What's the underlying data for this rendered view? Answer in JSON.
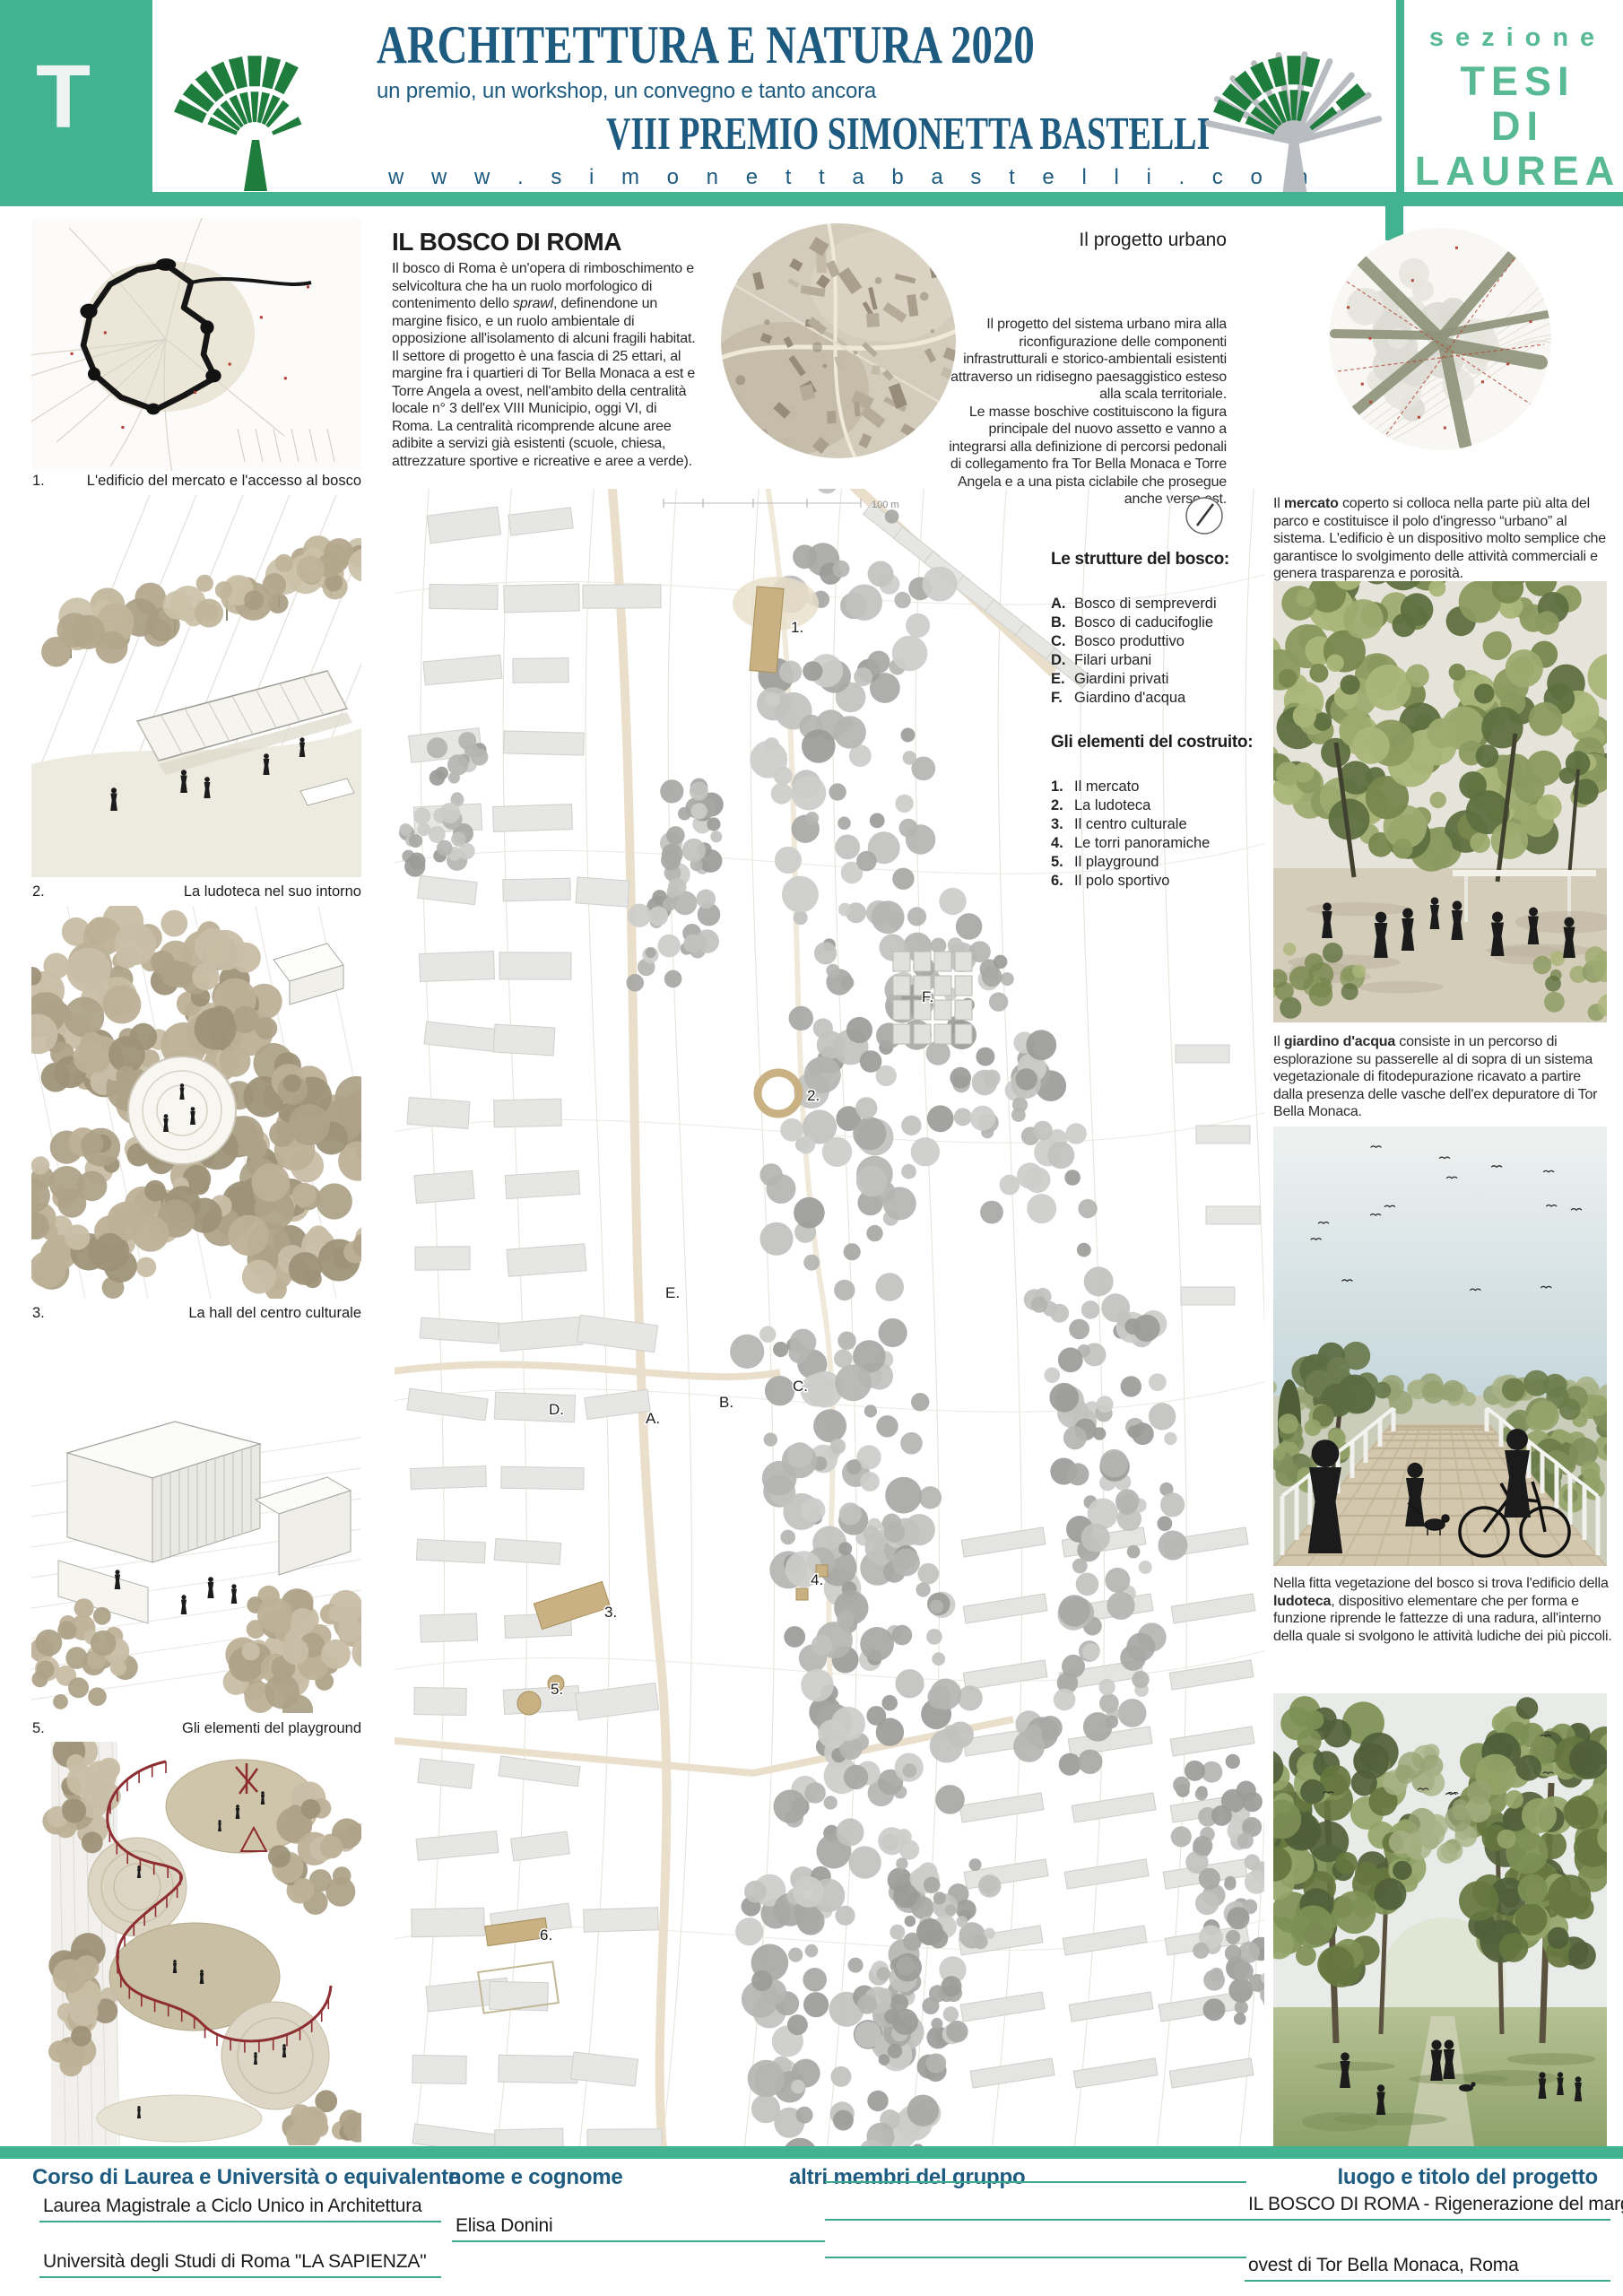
{
  "header": {
    "section_letter": "T",
    "title": "ARCHITETTURA E NATURA 2020",
    "subtitle": "un premio, un workshop, un convegno e tanto ancora",
    "prize_title": "VIII PREMIO SIMONETTA BASTELLI",
    "website": "w w w . s i m o n e t t a b a s t e l l i . c o m",
    "section_label": "sezione",
    "section_name_lines": [
      "TESI",
      "DI",
      "LAUREA"
    ]
  },
  "colors": {
    "accent_green": "#43b290",
    "text_green": "#57ba95",
    "title_blue": "#1e5b80",
    "underline_green": "#3aa98d",
    "logo_green": "#1e7c3c",
    "playground_red": "#8e2e31"
  },
  "intro": {
    "heading": "IL BOSCO DI ROMA",
    "p1_pre": "Il bosco di Roma è un'opera di rimboschimento e selvicoltura che ha un ruolo morfologico di contenimento dello ",
    "p1_italic": "sprawl",
    "p1_post": ", definendone un margine fisico, e un ruolo ambientale di opposizione all'isolamento di alcuni fragili habitat.",
    "p2": "Il settore di progetto è una fascia di 25 ettari, al margine fra i quartieri di Tor Bella Monaca a est e Torre Angela a ovest, nell'ambito della centralità locale n° 3 dell'ex VIII Municipio, oggi VI, di Roma. La centralità ricomprende alcune aree adibite a servizi già esistenti (scuole, chiesa, attrezzature sportive e ricreative e aree a verde)."
  },
  "urban": {
    "heading": "Il progetto urbano",
    "p1": "Il progetto del sistema urbano mira alla riconfigurazione delle componenti infrastrutturali e storico-ambientali esistenti attraverso un ridisegno paesaggistico esteso alla scala territoriale.",
    "p2": "Le masse boschive costituiscono la figura principale del nuovo assetto e vanno a integrarsi alla definizione di percorsi pedonali di collegamento fra Tor Bella Monaca e Torre Angela e a una pista ciclabile che prosegue anche verso est."
  },
  "left_figures": [
    {
      "number": "1.",
      "caption": "L'edificio del mercato e l'accesso al bosco"
    },
    {
      "number": "2.",
      "caption": "La ludoteca nel suo intorno"
    },
    {
      "number": "3.",
      "caption": "La hall del centro culturale"
    },
    {
      "number": "5.",
      "caption": "Gli elementi del playground"
    }
  ],
  "plan": {
    "scale_label": "100 m",
    "legend_structures": {
      "heading": "Le strutture del bosco:",
      "items": [
        {
          "key": "A.",
          "label": "Bosco di sempreverdi"
        },
        {
          "key": "B.",
          "label": "Bosco di caducifoglie"
        },
        {
          "key": "C.",
          "label": "Bosco produttivo"
        },
        {
          "key": "D.",
          "label": "Filari urbani"
        },
        {
          "key": "E.",
          "label": "Giardini privati"
        },
        {
          "key": "F.",
          "label": "Giardino d'acqua"
        }
      ]
    },
    "legend_built": {
      "heading": "Gli elementi del costruito:",
      "items": [
        {
          "key": "1.",
          "label": "Il mercato"
        },
        {
          "key": "2.",
          "label": "La ludoteca"
        },
        {
          "key": "3.",
          "label": "Il centro culturale"
        },
        {
          "key": "4.",
          "label": "Le torri panoramiche"
        },
        {
          "key": "5.",
          "label": "Il playground"
        },
        {
          "key": "6.",
          "label": "Il polo sportivo"
        }
      ]
    },
    "annotations": [
      "1.",
      "2.",
      "F.",
      "E.",
      "D.",
      "A.",
      "B.",
      "C.",
      "4.",
      "3.",
      "5.",
      "6."
    ]
  },
  "right_column": {
    "mercato": {
      "pre": "Il ",
      "bold": "mercato",
      "post": " coperto si colloca nella parte più alta del parco e costituisce il polo d'ingresso “urbano” al sistema. L'edificio è un dispositivo molto semplice che garantisce lo svolgimento delle attività commerciali e genera trasparenza e porosità."
    },
    "giardino": {
      "pre": "Il ",
      "bold": "giardino d'acqua",
      "post": " consiste in un percorso di esplorazione su passerelle al di sopra di un sistema vegetazionale di fitodepurazione ricavato a partire dalla presenza delle vasche dell'ex depuratore di Tor Bella Monaca."
    },
    "ludoteca": {
      "pre": "Nella fitta vegetazione del bosco si trova l'edificio della ",
      "bold": "ludoteca",
      "post": ", dispositivo elementare che per forma e funzione riprende le fattezze di una radura, all'interno della quale si svolgono le attività ludiche dei più piccoli."
    }
  },
  "footer": {
    "labels": {
      "course": "Corso di Laurea e Università o equivalente",
      "name": "nome e cognome",
      "members": "altri membri del gruppo",
      "project": "luogo e titolo del progetto"
    },
    "course_values": [
      "Laurea Magistrale a Ciclo Unico in Architettura",
      "Università degli Studi di Roma \"LA SAPIENZA\""
    ],
    "name_value": "Elisa Donini",
    "project_values": [
      "IL BOSCO DI ROMA - Rigenerazione del margine",
      "ovest di Tor Bella Monaca, Roma"
    ]
  }
}
